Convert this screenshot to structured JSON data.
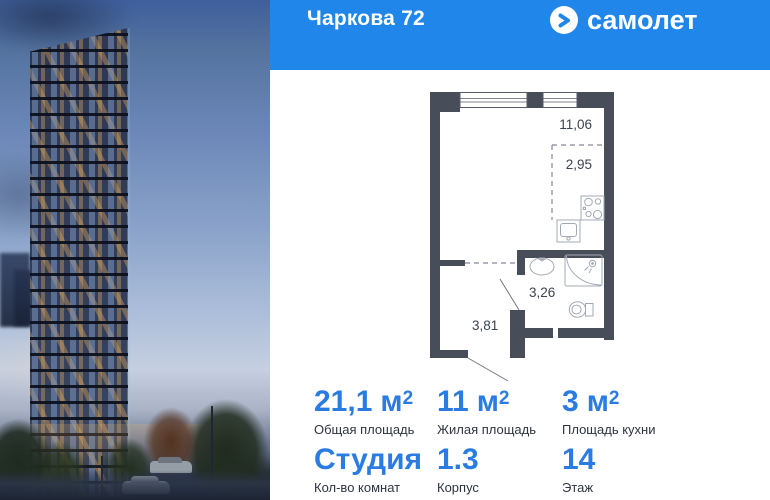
{
  "header": {
    "title": "Чаркова 72",
    "brand": "самолет"
  },
  "colors": {
    "header_bg": "#2186e9",
    "accent_blue": "#2b7ce2",
    "wall": "#484d5a"
  },
  "floorplan": {
    "labels": {
      "room": "11,06",
      "kitchen": "2,95",
      "bathroom": "3,26",
      "hallway": "3,81"
    }
  },
  "stats": {
    "row1": [
      {
        "value": "21,1",
        "unit": "м",
        "unit_sup": "2",
        "label": "Общая площадь"
      },
      {
        "value": "11",
        "unit": "м",
        "unit_sup": "2",
        "label": "Жилая площадь"
      },
      {
        "value": "3",
        "unit": "м",
        "unit_sup": "2",
        "label": "Площадь кухни"
      }
    ],
    "row2": [
      {
        "value": "Студия",
        "label": "Кол-во комнат"
      },
      {
        "value": "1.3",
        "label": "Корпус"
      },
      {
        "value": "14",
        "label": "Этаж"
      }
    ]
  }
}
